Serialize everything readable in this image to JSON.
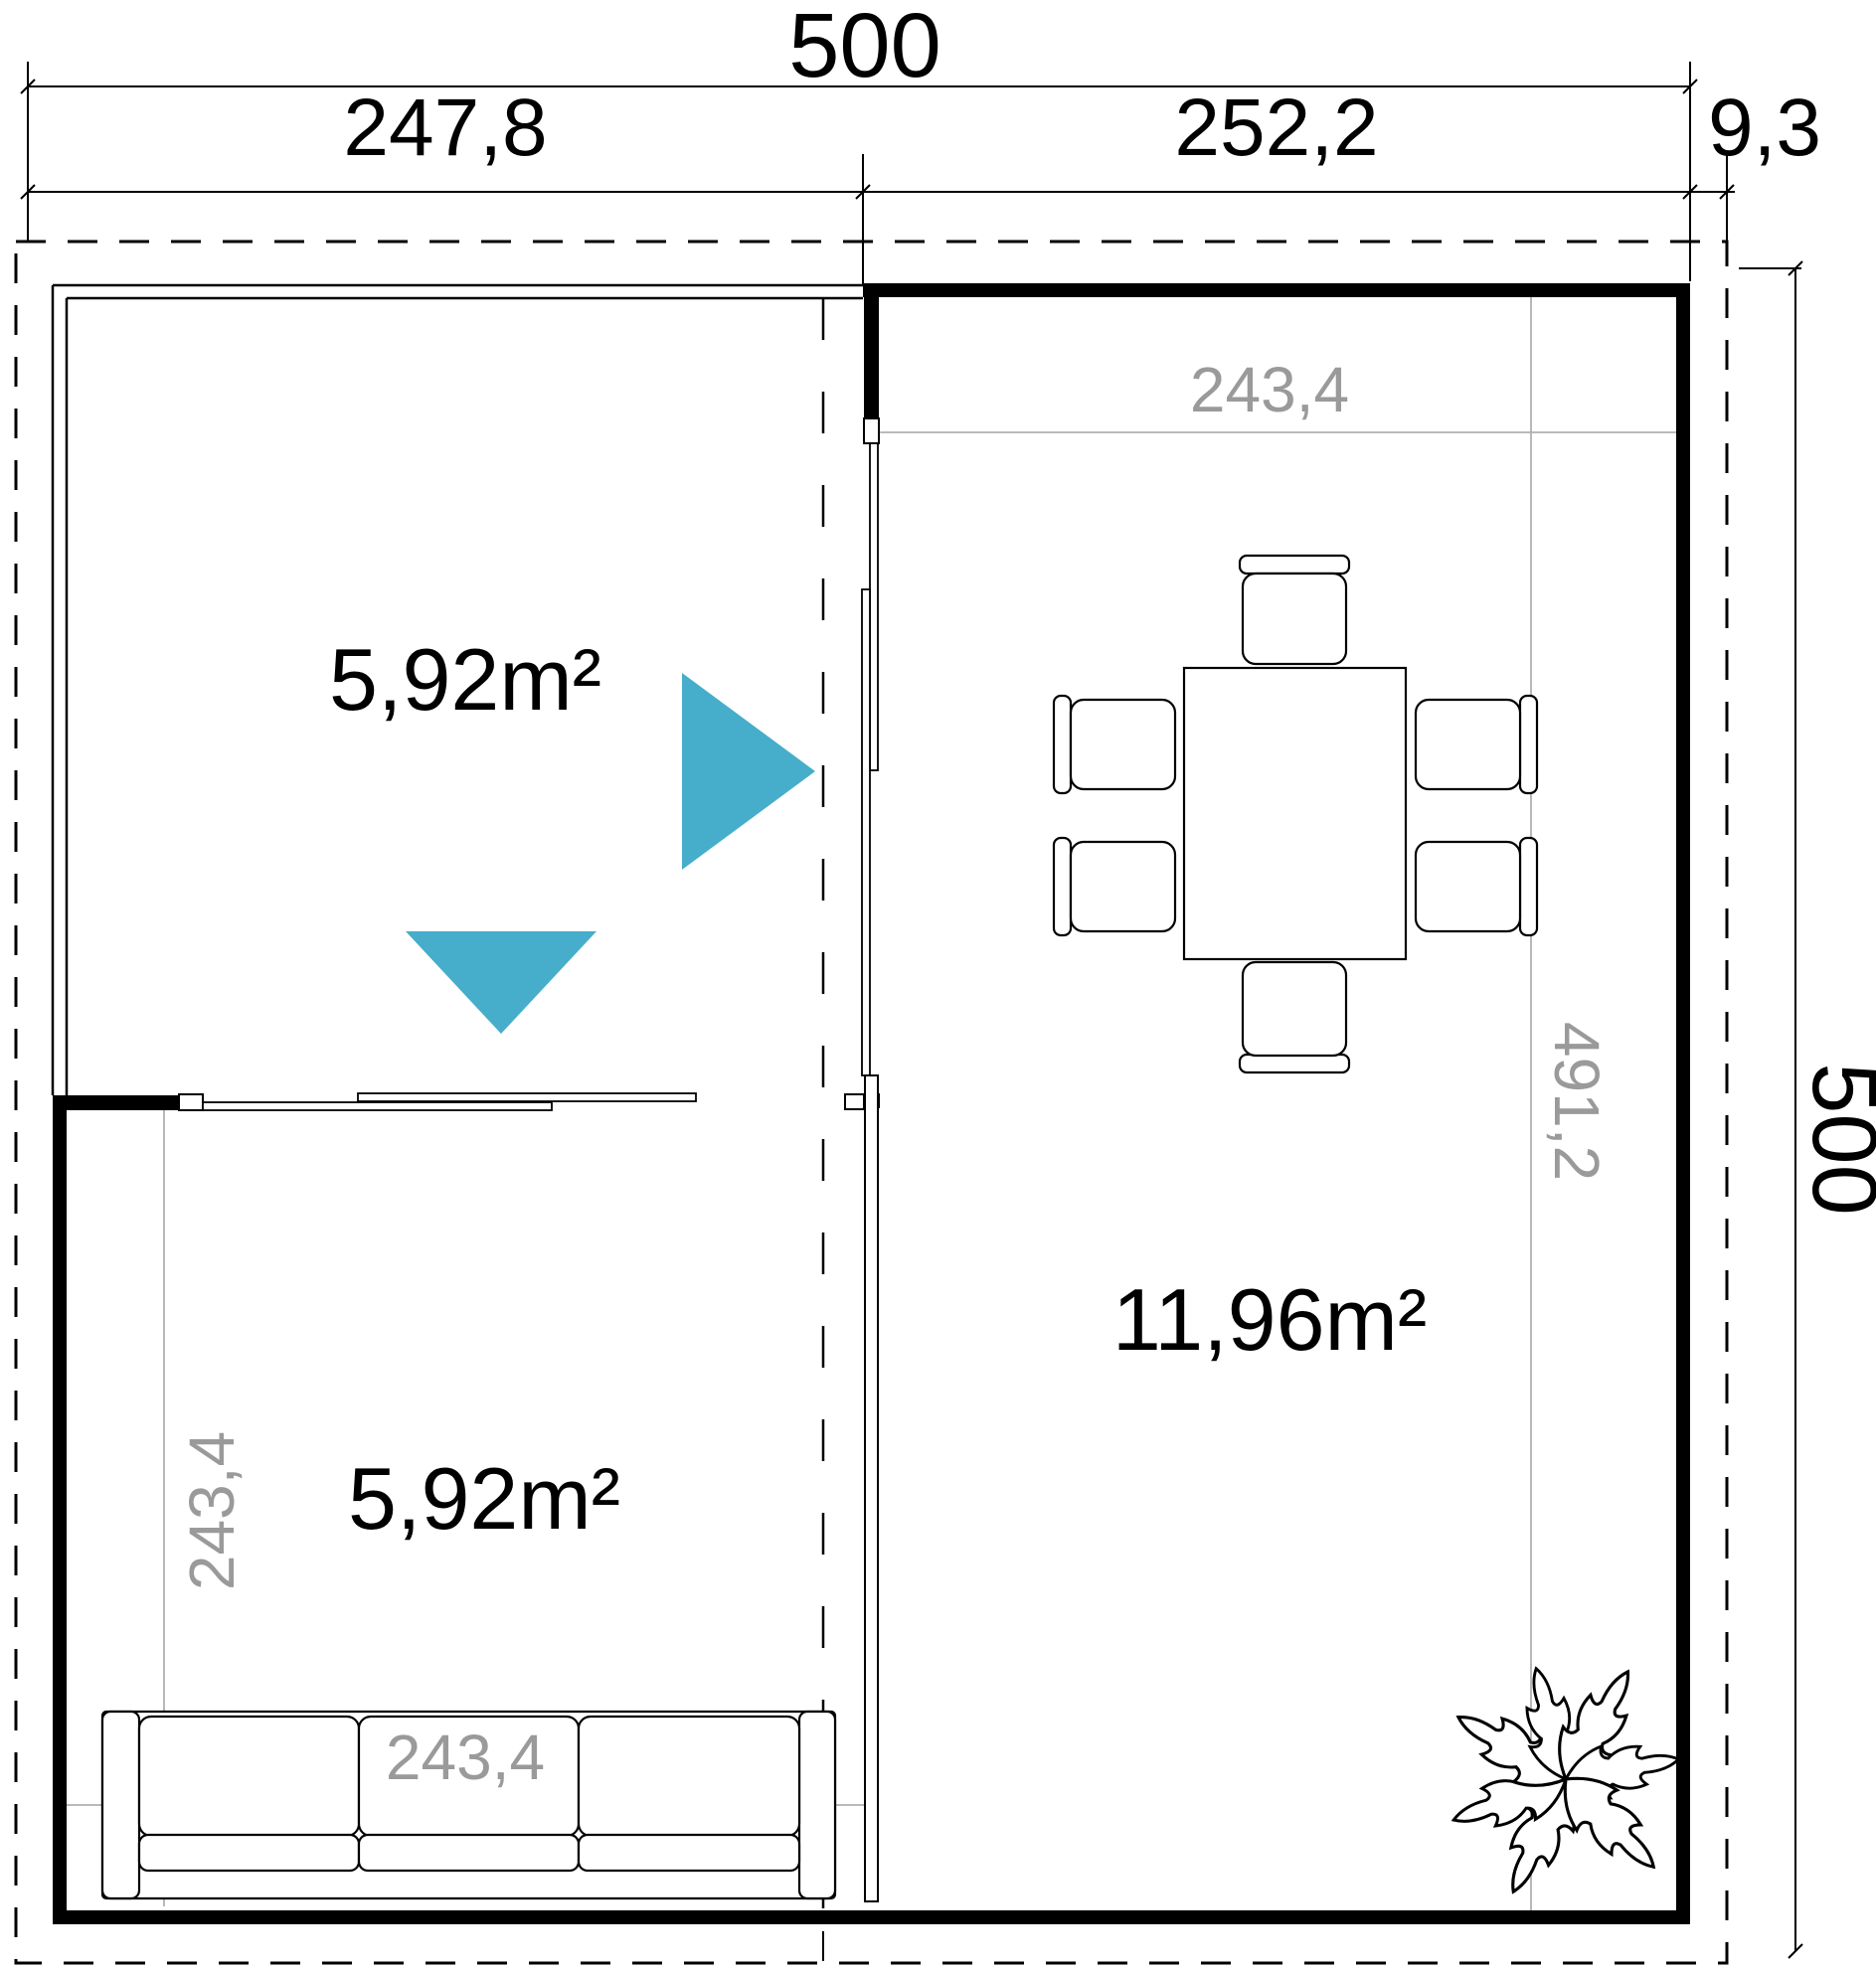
{
  "drawing": {
    "type": "floor-plan",
    "units": "cm"
  },
  "colors": {
    "accent_triangle": "#46adcb",
    "dimension_gray_text": "#9a9a9a",
    "interior_line_gray": "#b0b0b0",
    "wall_black": "#000000",
    "background": "#ffffff"
  },
  "labels": {
    "overall_width": "500",
    "overall_height": "500",
    "top_segment_left": "247,8",
    "top_segment_right": "252,2",
    "top_segment_overhang": "9,3",
    "area_porch": "5,92m²",
    "area_lounge": "5,92m²",
    "area_main_room": "11,96m²",
    "main_room_inner_width": "243,4",
    "main_room_inner_height": "491,2",
    "lounge_inner_height": "243,4",
    "lounge_inner_width": "243,4"
  },
  "rooms": [
    {
      "name": "porch-top-left",
      "area": "5,92m²"
    },
    {
      "name": "lounge-bottom-left",
      "area": "5,92m²"
    },
    {
      "name": "main-room-right",
      "area": "11,96m²"
    }
  ],
  "furniture": [
    "dining-table-six-chairs",
    "three-seat-sofa",
    "plant"
  ]
}
